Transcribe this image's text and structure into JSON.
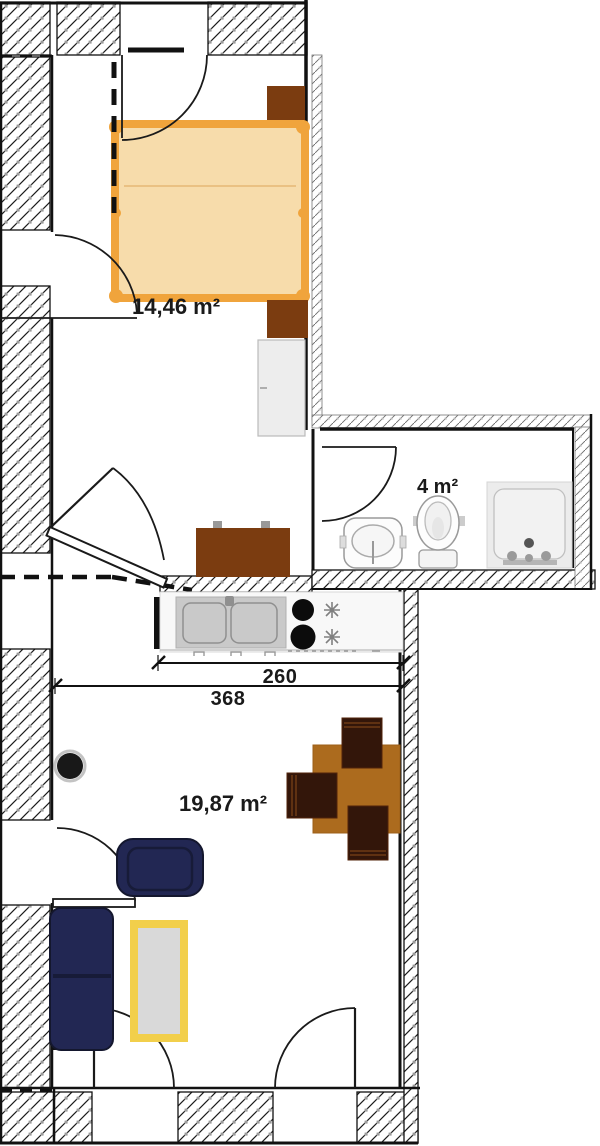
{
  "plan_title": "apartment floor plan",
  "rooms": [
    {
      "name": "bedroom",
      "area_label": "14,46 m²"
    },
    {
      "name": "bathroom",
      "area_label": "4 m²"
    },
    {
      "name": "living-room",
      "area_label": "19,87 m²"
    }
  ],
  "dimensions": [
    {
      "name": "kitchen-counter-width",
      "label": "260"
    },
    {
      "name": "living-room-width",
      "label": "368"
    }
  ],
  "furniture": [
    "double-bed",
    "nightstand-top",
    "nightstand-bottom",
    "wardrobe",
    "hall-dresser",
    "kitchen-counter",
    "kitchen-double-sink",
    "cooktop-burner",
    "cooktop-burner",
    "dining-table",
    "dining-chair",
    "dining-chair",
    "dining-chair",
    "wood-stove",
    "armchair",
    "sofa",
    "coffee-table",
    "bathroom-sink",
    "toilet",
    "shower-tray"
  ],
  "colors": {
    "bed_fill": "#f7dcab",
    "bed_frame": "#f0a43c",
    "bed_inner_line": "#eac183",
    "dark_wood": "#7b3c10",
    "table_wood": "#ac6b1e",
    "chair_wood": "#33160a",
    "sofa_navy": "#222753",
    "coffee_table_frame": "#f2cf4b",
    "coffee_table_top": "#d9d9d9",
    "counter_sink_gray": "#c9c9c9",
    "fixture_gray": "#ececec"
  }
}
